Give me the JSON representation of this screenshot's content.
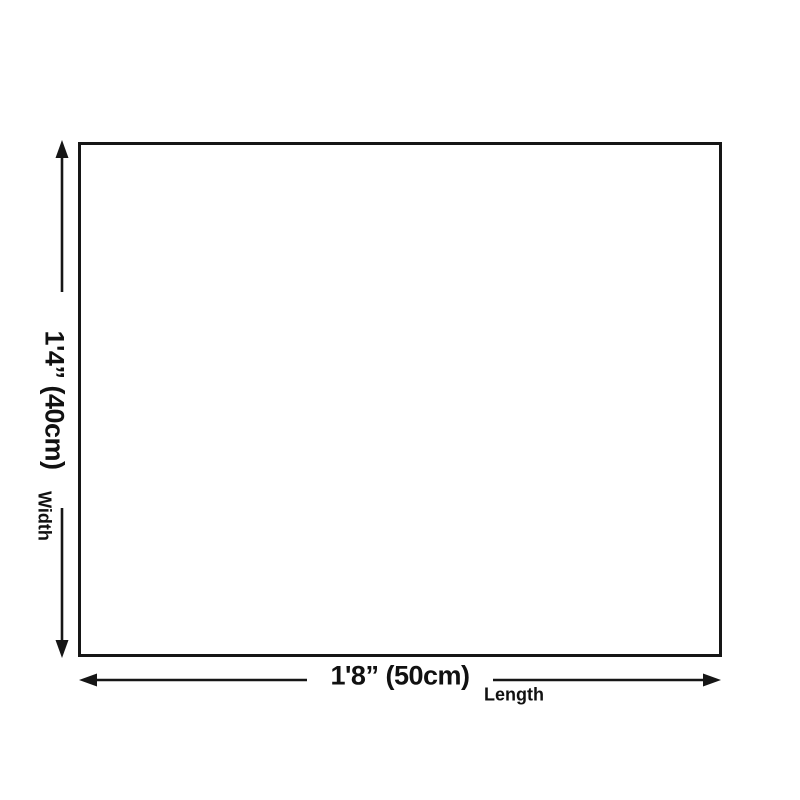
{
  "page": {
    "background_color": "#ffffff"
  },
  "diagram": {
    "type": "product-dimension-diagram",
    "panel": {
      "fill_color": "#ffffff",
      "border_color": "#161616"
    },
    "line_color": "#161616",
    "text_color": "#111111",
    "width": {
      "dimension_label": "1'4” (40cm)",
      "axis_label": "Width"
    },
    "length": {
      "dimension_label": "1'8” (50cm)",
      "axis_label": "Length"
    }
  }
}
